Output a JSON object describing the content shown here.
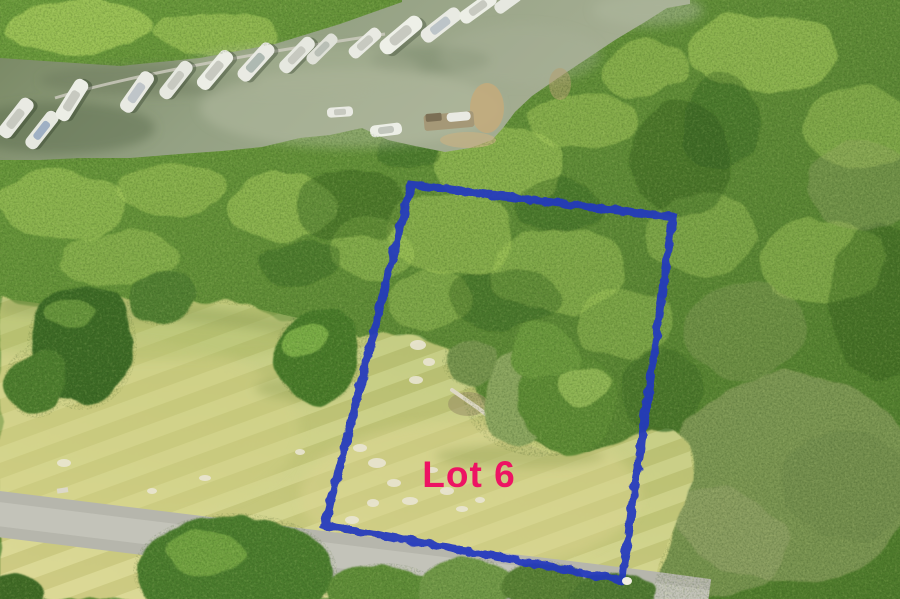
{
  "image": {
    "type": "aerial-drone-photo",
    "description": "Aerial view of a wooded lakefront building lot outlined in blue and labeled Lot 6, with a marina of docked pontoon boats on the lake channel above, dense forest in the middle and right, a mowed grass field with scattered rocks below, and a paved road crossing the bottom left corner"
  },
  "overlay": {
    "lot_label": "Lot 6",
    "label_color": "#ed1363",
    "boundary_color": "#2437bf",
    "boundary_points": "411,185 673,217 622,580 325,525",
    "boundary_stroke_width": "8.5"
  },
  "scene": {
    "water_color": "#8e9c7d",
    "forest_color": "#5d8836",
    "grass_color": "#c9cd7f",
    "road_color": "#b6b6ac",
    "boat_color": "#e9eae3",
    "boat_count": 16,
    "features": [
      "lake-channel",
      "marina-boats",
      "forest",
      "grass-field",
      "mowing-stripes",
      "road",
      "rock-outcrops",
      "fallen-log",
      "lot-boundary",
      "lot-label"
    ]
  }
}
